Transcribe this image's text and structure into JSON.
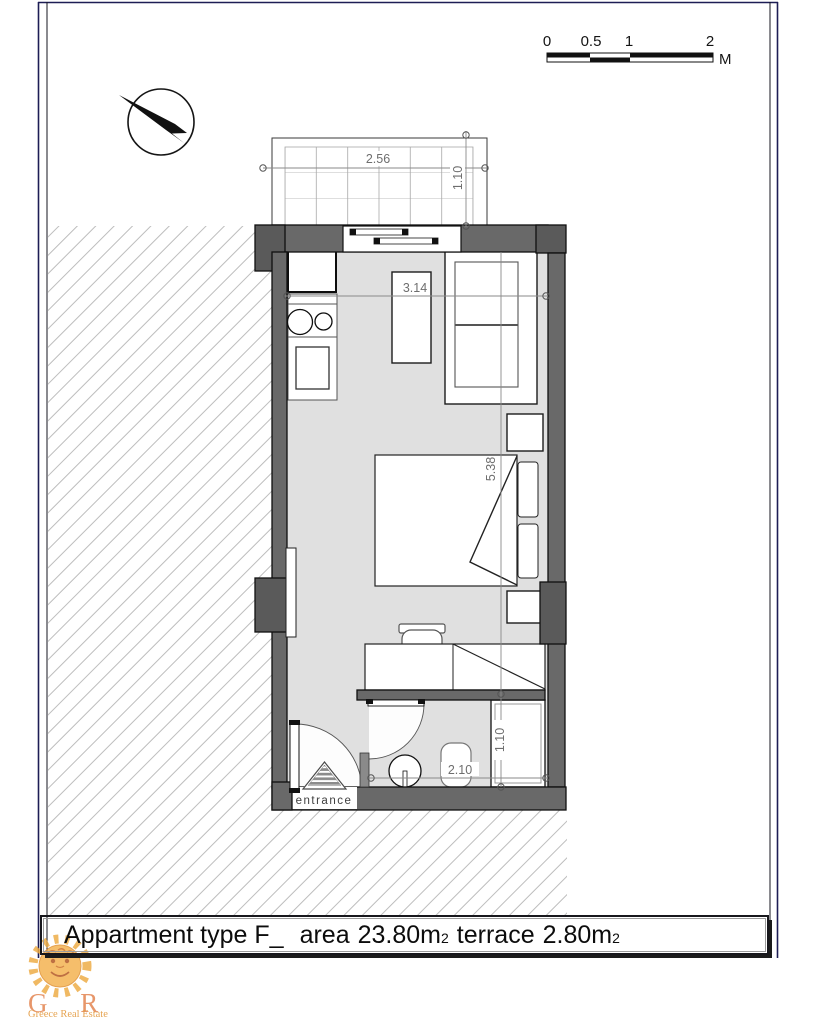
{
  "scale_bar": {
    "labels": [
      "0",
      "0.5",
      "1",
      "2"
    ],
    "unit": "M"
  },
  "dimensions": {
    "terrace_width": "2.56",
    "terrace_depth": "1.10",
    "room_width": "3.14",
    "room_length": "5.38",
    "bathroom_width": "2.10",
    "shower_depth": "1.10"
  },
  "labels": {
    "entrance": "entrance"
  },
  "title": {
    "apartment": "Appartment type F_",
    "area_label": "area",
    "area_value": "23.80",
    "area_unit": "m",
    "area_subscript": "2",
    "terrace_label": "terrace",
    "terrace_value": "2.80",
    "terrace_unit": "m",
    "terrace_subscript": "2"
  },
  "logo": {
    "initials": "G R E",
    "tagline": "Greece Real Estate"
  },
  "colors": {
    "wall_gray": "#696969",
    "floor_gray": "#e0e0e0",
    "hatch_gray": "#bdbdbd",
    "frame_navy": "#1d1d55",
    "logo_orange": "#de6f31",
    "sun_orange": "#f4b04b"
  }
}
